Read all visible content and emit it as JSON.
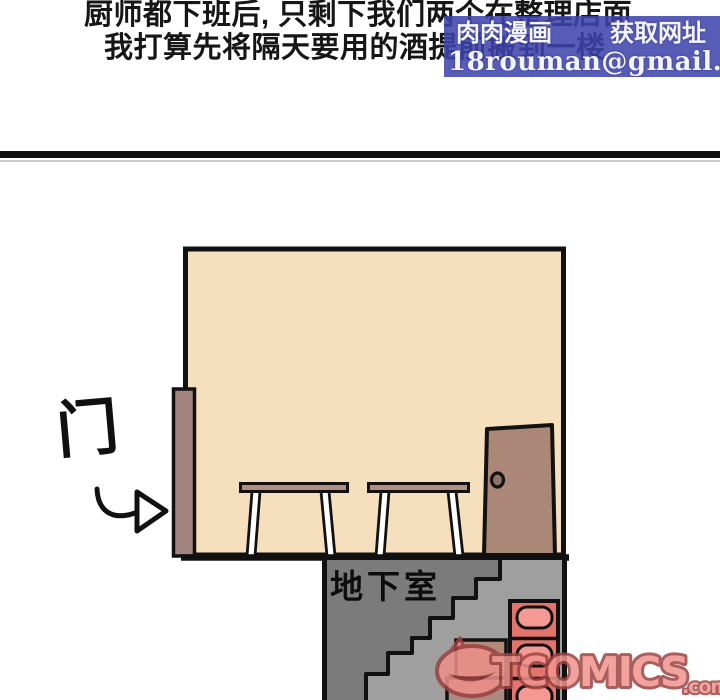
{
  "narration": {
    "line1": "厨师都下班后, 只剩下我们两个在整理店面",
    "line2": "我打算先将隔天要用的酒提前搬到一楼"
  },
  "watermark_top": {
    "site_name": "肉肉漫画",
    "tagline": "获取网址",
    "email": "18rouman@gmail.com",
    "bg_color": "#3e44ac",
    "text_color": "#f4f4ff"
  },
  "scene": {
    "door_label": "门",
    "basement_label": "地下室",
    "colors": {
      "room_fill": "#f6dfbc",
      "outline": "#111111",
      "open_door_fill": "#a3837d",
      "door_fill": "#aa8777",
      "door_knob_fill": "#8d7265",
      "table_top_fill": "#b38e83",
      "table_leg_fill": "#ffffff",
      "basement_wall_fill": "#7b7b7b",
      "stairwell_fill": "#9f9f9f",
      "crate_upper_fill": "#b18a7a",
      "crate_lower_fill": "#aa8a7e",
      "wine_rack_fill": "#e2746c",
      "wine_slot_fill": "#f59a93",
      "arrow_fill": "#ffffff"
    }
  },
  "watermark_bottom": {
    "brand": "TCOMICS",
    "tld": ".com",
    "fill": "#f2948d",
    "outline": "#9c4343"
  }
}
